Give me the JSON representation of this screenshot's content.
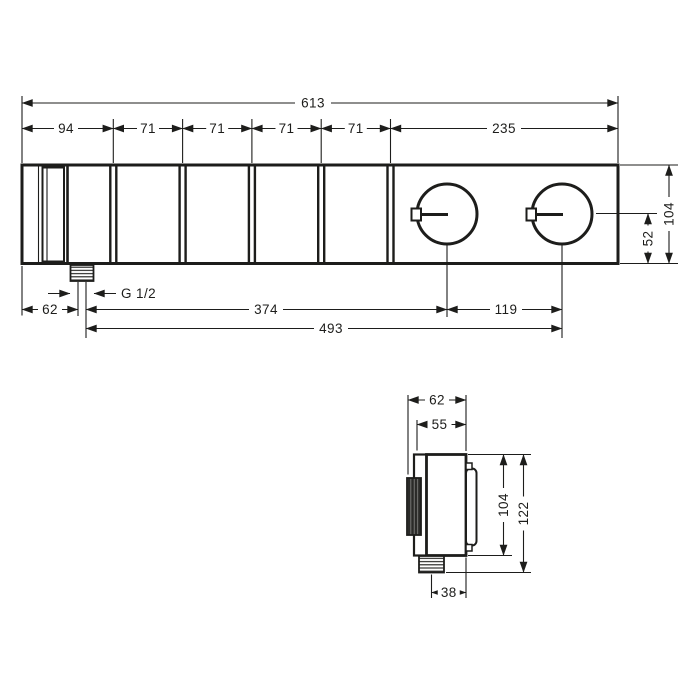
{
  "drawing": {
    "kind": "technical-dimension-drawing",
    "line_color": "#1d1d1b",
    "background": "#ffffff"
  },
  "front_view": {
    "width_total": "613",
    "segment_widths": [
      "94",
      "71",
      "71",
      "71",
      "71",
      "235"
    ],
    "height_total": "104",
    "handle_center_from_bottom": "52",
    "edge_to_outlet": "62",
    "outlet_to_handle1": "374",
    "handle_spacing": "119",
    "outlet_to_handle2": "493",
    "outlet_thread": "G 1/2"
  },
  "side_view": {
    "depth_overall": "62",
    "depth_plate": "55",
    "height_body": "104",
    "height_overall": "122",
    "outlet_to_back": "38"
  }
}
